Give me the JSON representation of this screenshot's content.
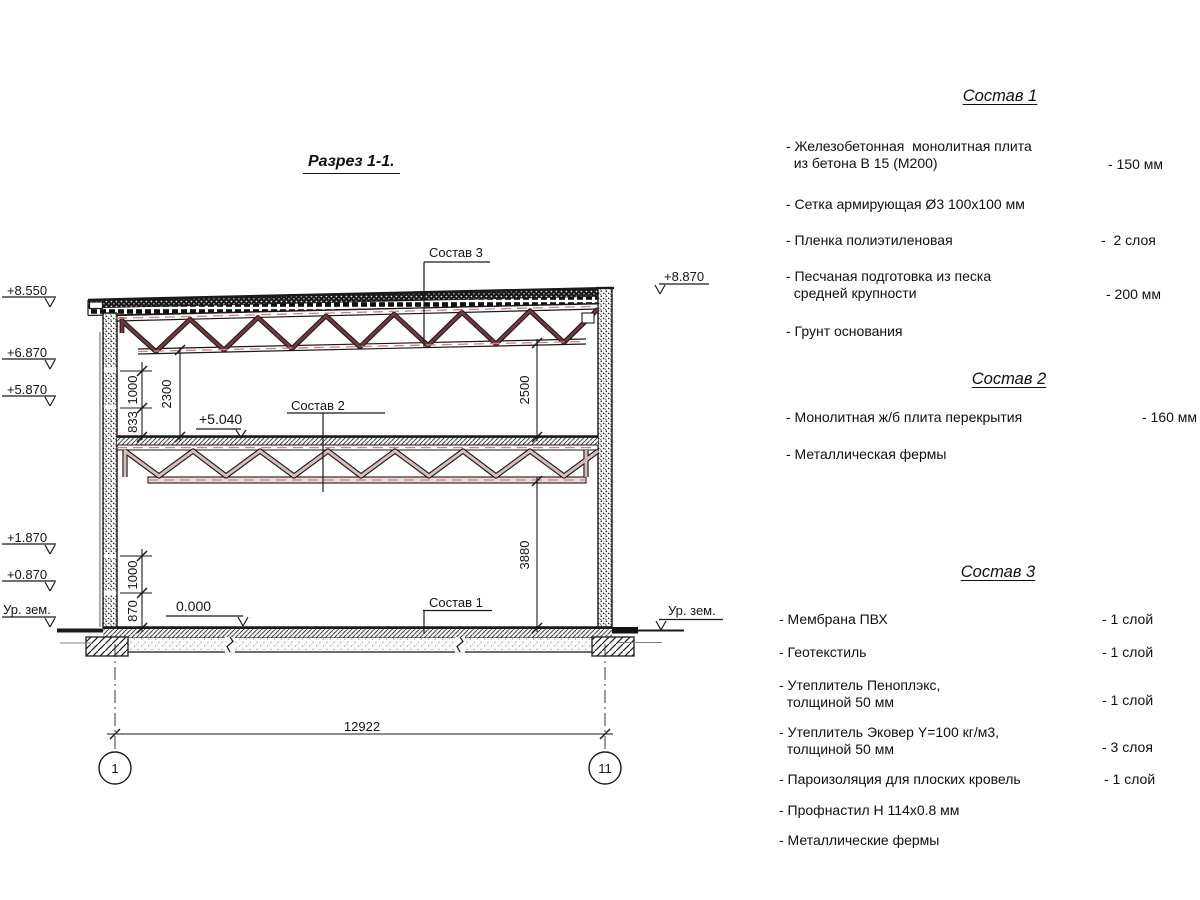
{
  "title": "Разрез 1-1.",
  "colors": {
    "line": "#1a1a1a",
    "truss_roof_web_outline": "#2a1418",
    "truss_roof_web": "#6e3b42",
    "truss_floor_web_outline": "#141414",
    "truss_floor_web": "#d9bcbc",
    "centerline_red": "#d4807d"
  },
  "drawing": {
    "callout_1": "Состав 1",
    "callout_2": "Состав 2",
    "callout_3": "Состав 3",
    "elev_left": [
      "+8.550",
      "+6.870",
      "+5.870",
      "+1.870",
      "+0.870"
    ],
    "ground_left": "Ур. зем.",
    "ground_right": "Ур. зем.",
    "elev_right": "+8.870",
    "elev_slab": "+5.040",
    "elev_floor": "0.000",
    "dim_1000_top": "1000",
    "dim_833": "833",
    "dim_2300": "2300",
    "dim_2500": "2500",
    "dim_3880": "3880",
    "dim_1000_bottom": "1000",
    "dim_870": "870",
    "dim_span": "12922",
    "axis_left": "1",
    "axis_right": "11"
  },
  "specs": [
    {
      "heading": "Состав 1",
      "items": [
        {
          "label": "- Железобетонная  монолитная плита\n  из бетона В 15 (М200)",
          "value": "- 150 мм"
        },
        {
          "label": "- Сетка армирующая Ø3 100х100 мм",
          "value": ""
        },
        {
          "label": "- Пленка полиэтиленовая",
          "value": "-  2 слоя"
        },
        {
          "label": "- Песчаная подготовка из песка\n  средней крупности",
          "value": "- 200 мм"
        },
        {
          "label": "- Грунт основания",
          "value": ""
        }
      ]
    },
    {
      "heading": "Состав 2",
      "items": [
        {
          "label": "- Монолитная ж/б плита перекрытия",
          "value": "- 160 мм"
        },
        {
          "label": "- Металлическая фермы",
          "value": ""
        }
      ]
    },
    {
      "heading": "Состав 3",
      "items": [
        {
          "label": "- Мембрана ПВХ",
          "value": "- 1 слой"
        },
        {
          "label": "- Геотекстиль",
          "value": "- 1 слой"
        },
        {
          "label": "- Утеплитель Пеноплэкс,\n  толщиной 50 мм",
          "value": "- 1 слой"
        },
        {
          "label": "- Утеплитель Эковер Y=100 кг/м3,\n  толщиной 50 мм",
          "value": "- 3 слоя"
        },
        {
          "label": "- Пароизоляция для плоских кровель",
          "value": "- 1 слой"
        },
        {
          "label": "- Профнастил Н 114х0.8 мм",
          "value": ""
        },
        {
          "label": "- Металлические фермы",
          "value": ""
        }
      ]
    }
  ]
}
